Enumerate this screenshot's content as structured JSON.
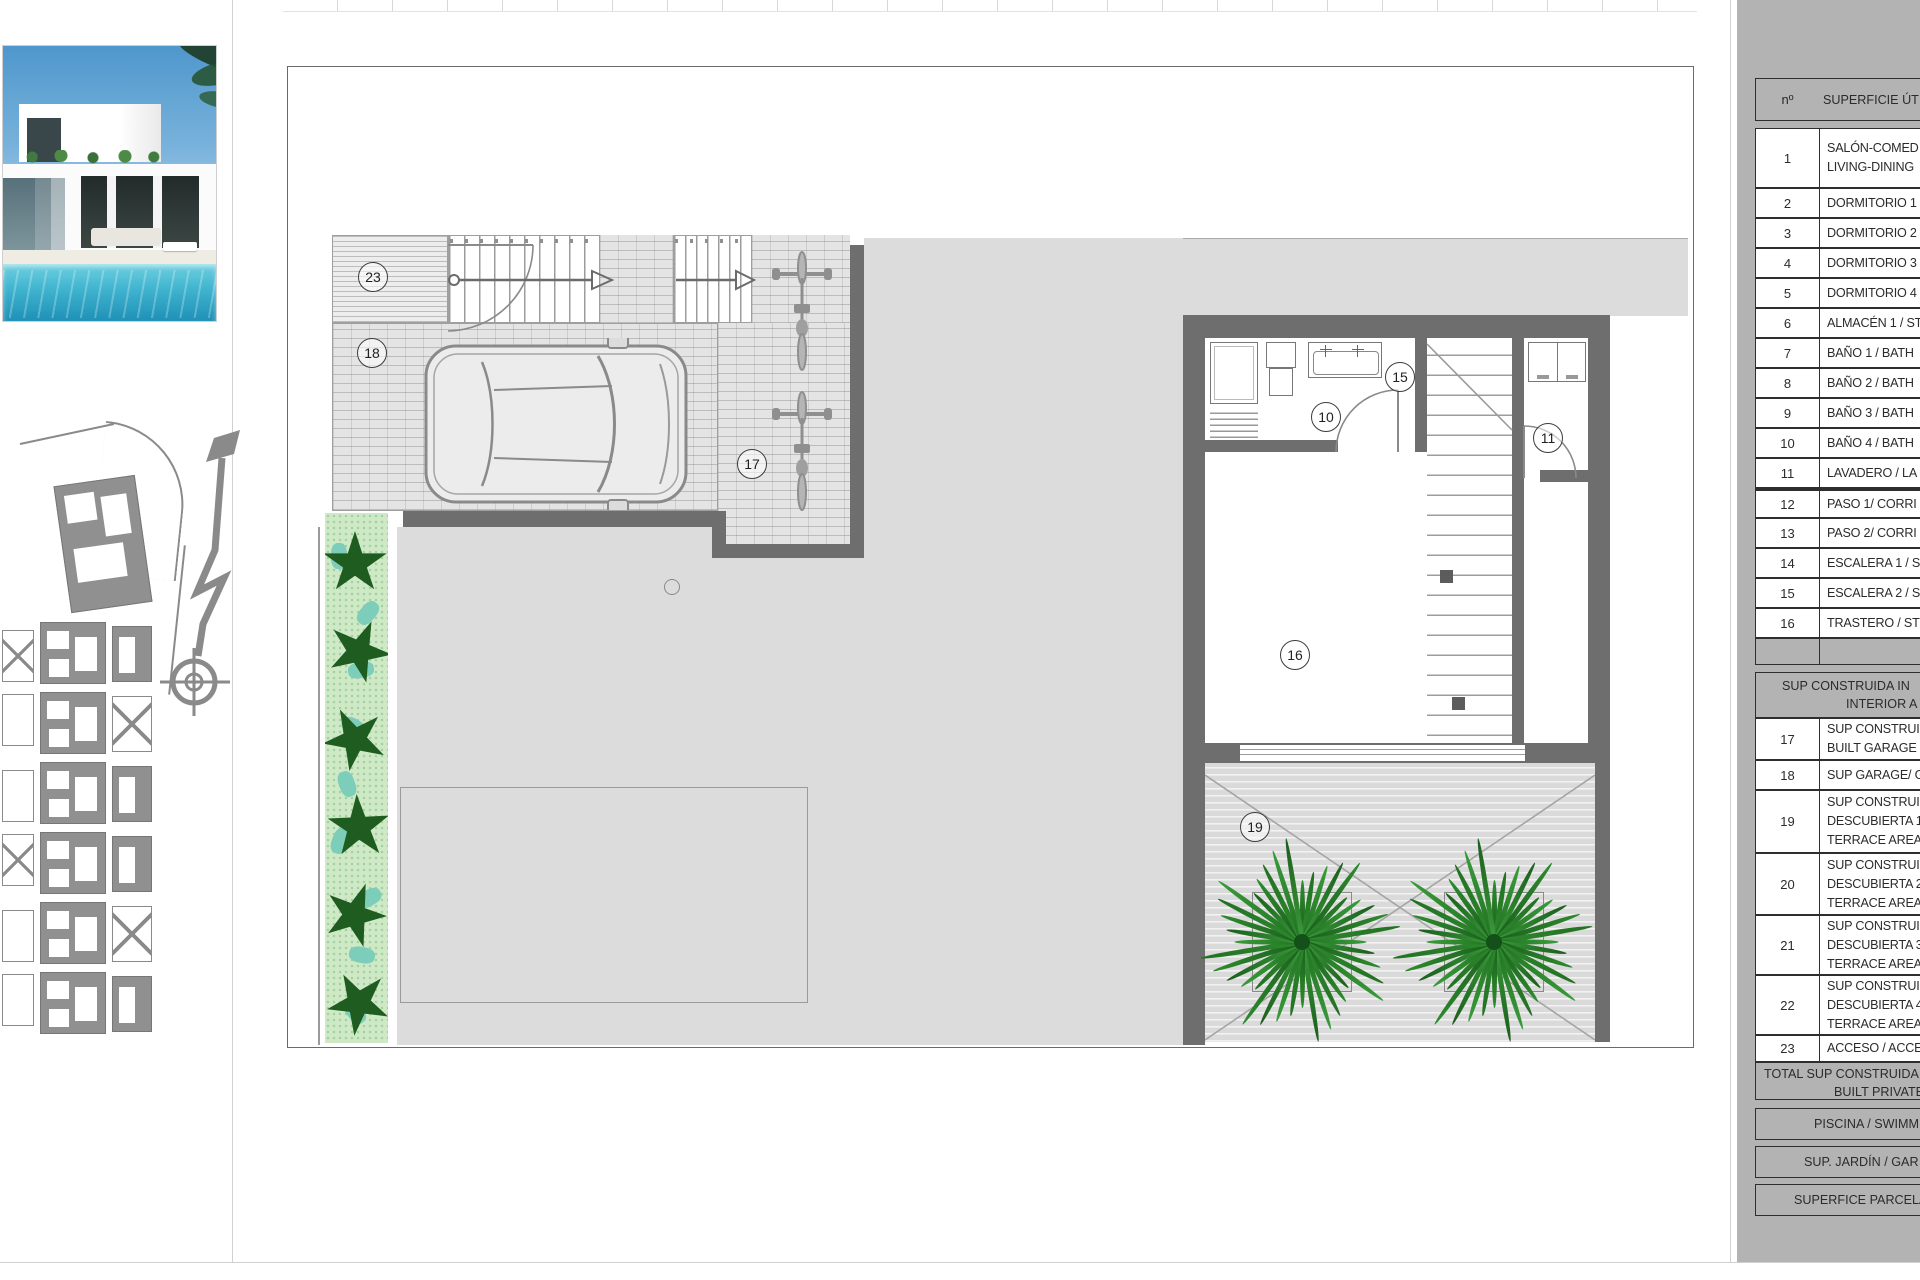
{
  "panel": {
    "header": {
      "num": "nº",
      "desc": "SUPERFICIE ÚTI"
    },
    "rooms": [
      {
        "num": "1",
        "lines": [
          "SALÓN-COMED",
          "LIVING-DINING"
        ]
      },
      {
        "num": "2",
        "lines": [
          "DORMITORIO 1"
        ]
      },
      {
        "num": "3",
        "lines": [
          "DORMITORIO 2"
        ]
      },
      {
        "num": "4",
        "lines": [
          "DORMITORIO 3"
        ]
      },
      {
        "num": "5",
        "lines": [
          "DORMITORIO 4"
        ]
      },
      {
        "num": "6",
        "lines": [
          "ALMACÉN 1 / ST"
        ]
      },
      {
        "num": "7",
        "lines": [
          "BAÑO 1 / BATH"
        ]
      },
      {
        "num": "8",
        "lines": [
          "BAÑO 2 / BATH"
        ]
      },
      {
        "num": "9",
        "lines": [
          "BAÑO 3 / BATH"
        ]
      },
      {
        "num": "10",
        "lines": [
          "BAÑO 4 / BATH"
        ]
      },
      {
        "num": "11",
        "lines": [
          "LAVADERO / LA"
        ]
      },
      {
        "num": "12",
        "lines": [
          "PASO 1/ CORRI"
        ]
      },
      {
        "num": "13",
        "lines": [
          "PASO 2/ CORRI"
        ]
      },
      {
        "num": "14",
        "lines": [
          "ESCALERA 1 / ST"
        ]
      },
      {
        "num": "15",
        "lines": [
          "ESCALERA 2 / ST"
        ]
      },
      {
        "num": "16",
        "lines": [
          "TRASTERO / STO"
        ]
      }
    ],
    "section2_header": {
      "line1": "SUP CONSTRUIDA IN",
      "line2": "INTERIOR A"
    },
    "areas": [
      {
        "num": "17",
        "lines": [
          "SUP CONSTRUI",
          "BUILT GARAGE"
        ]
      },
      {
        "num": "18",
        "lines": [
          "SUP GARAGE/ G"
        ]
      },
      {
        "num": "19",
        "lines": [
          "SUP CONSTRUI",
          "DESCUBIERTA 1",
          "TERRACE AREA"
        ]
      },
      {
        "num": "20",
        "lines": [
          "SUP CONSTRUI",
          "DESCUBIERTA 2",
          "TERRACE AREA"
        ]
      },
      {
        "num": "21",
        "lines": [
          "SUP CONSTRUI",
          "DESCUBIERTA 3",
          "TERRACE AREA"
        ]
      },
      {
        "num": "22",
        "lines": [
          "SUP CONSTRUI",
          "DESCUBIERTA 4",
          "TERRACE AREA"
        ]
      },
      {
        "num": "23",
        "lines": [
          "ACCESO / ACCE"
        ]
      }
    ],
    "total": {
      "line1": "TOTAL SUP CONSTRUIDA",
      "line2": "BUILT PRIVATE"
    },
    "footer": [
      {
        "label": "PISCINA / SWIMM"
      },
      {
        "label": "SUP. JARDÍN / GAR"
      },
      {
        "label": "SUPERFICE PARCELA"
      }
    ]
  },
  "plan_labels": {
    "c23": "23",
    "c18": "18",
    "c17": "17",
    "c10": "10",
    "c15": "15",
    "c11": "11",
    "c16": "16",
    "c19": "19"
  },
  "colors": {
    "panel_gray": "#b3b3b3",
    "wall_gray": "#6e6e6e",
    "courtyard_gray": "#dcdcdc",
    "hedge_green": "#1f5c20",
    "palm_green": "#2e8b2e",
    "pool_blue": "#3fb3cf",
    "sky_blue": "#4f97cc"
  }
}
